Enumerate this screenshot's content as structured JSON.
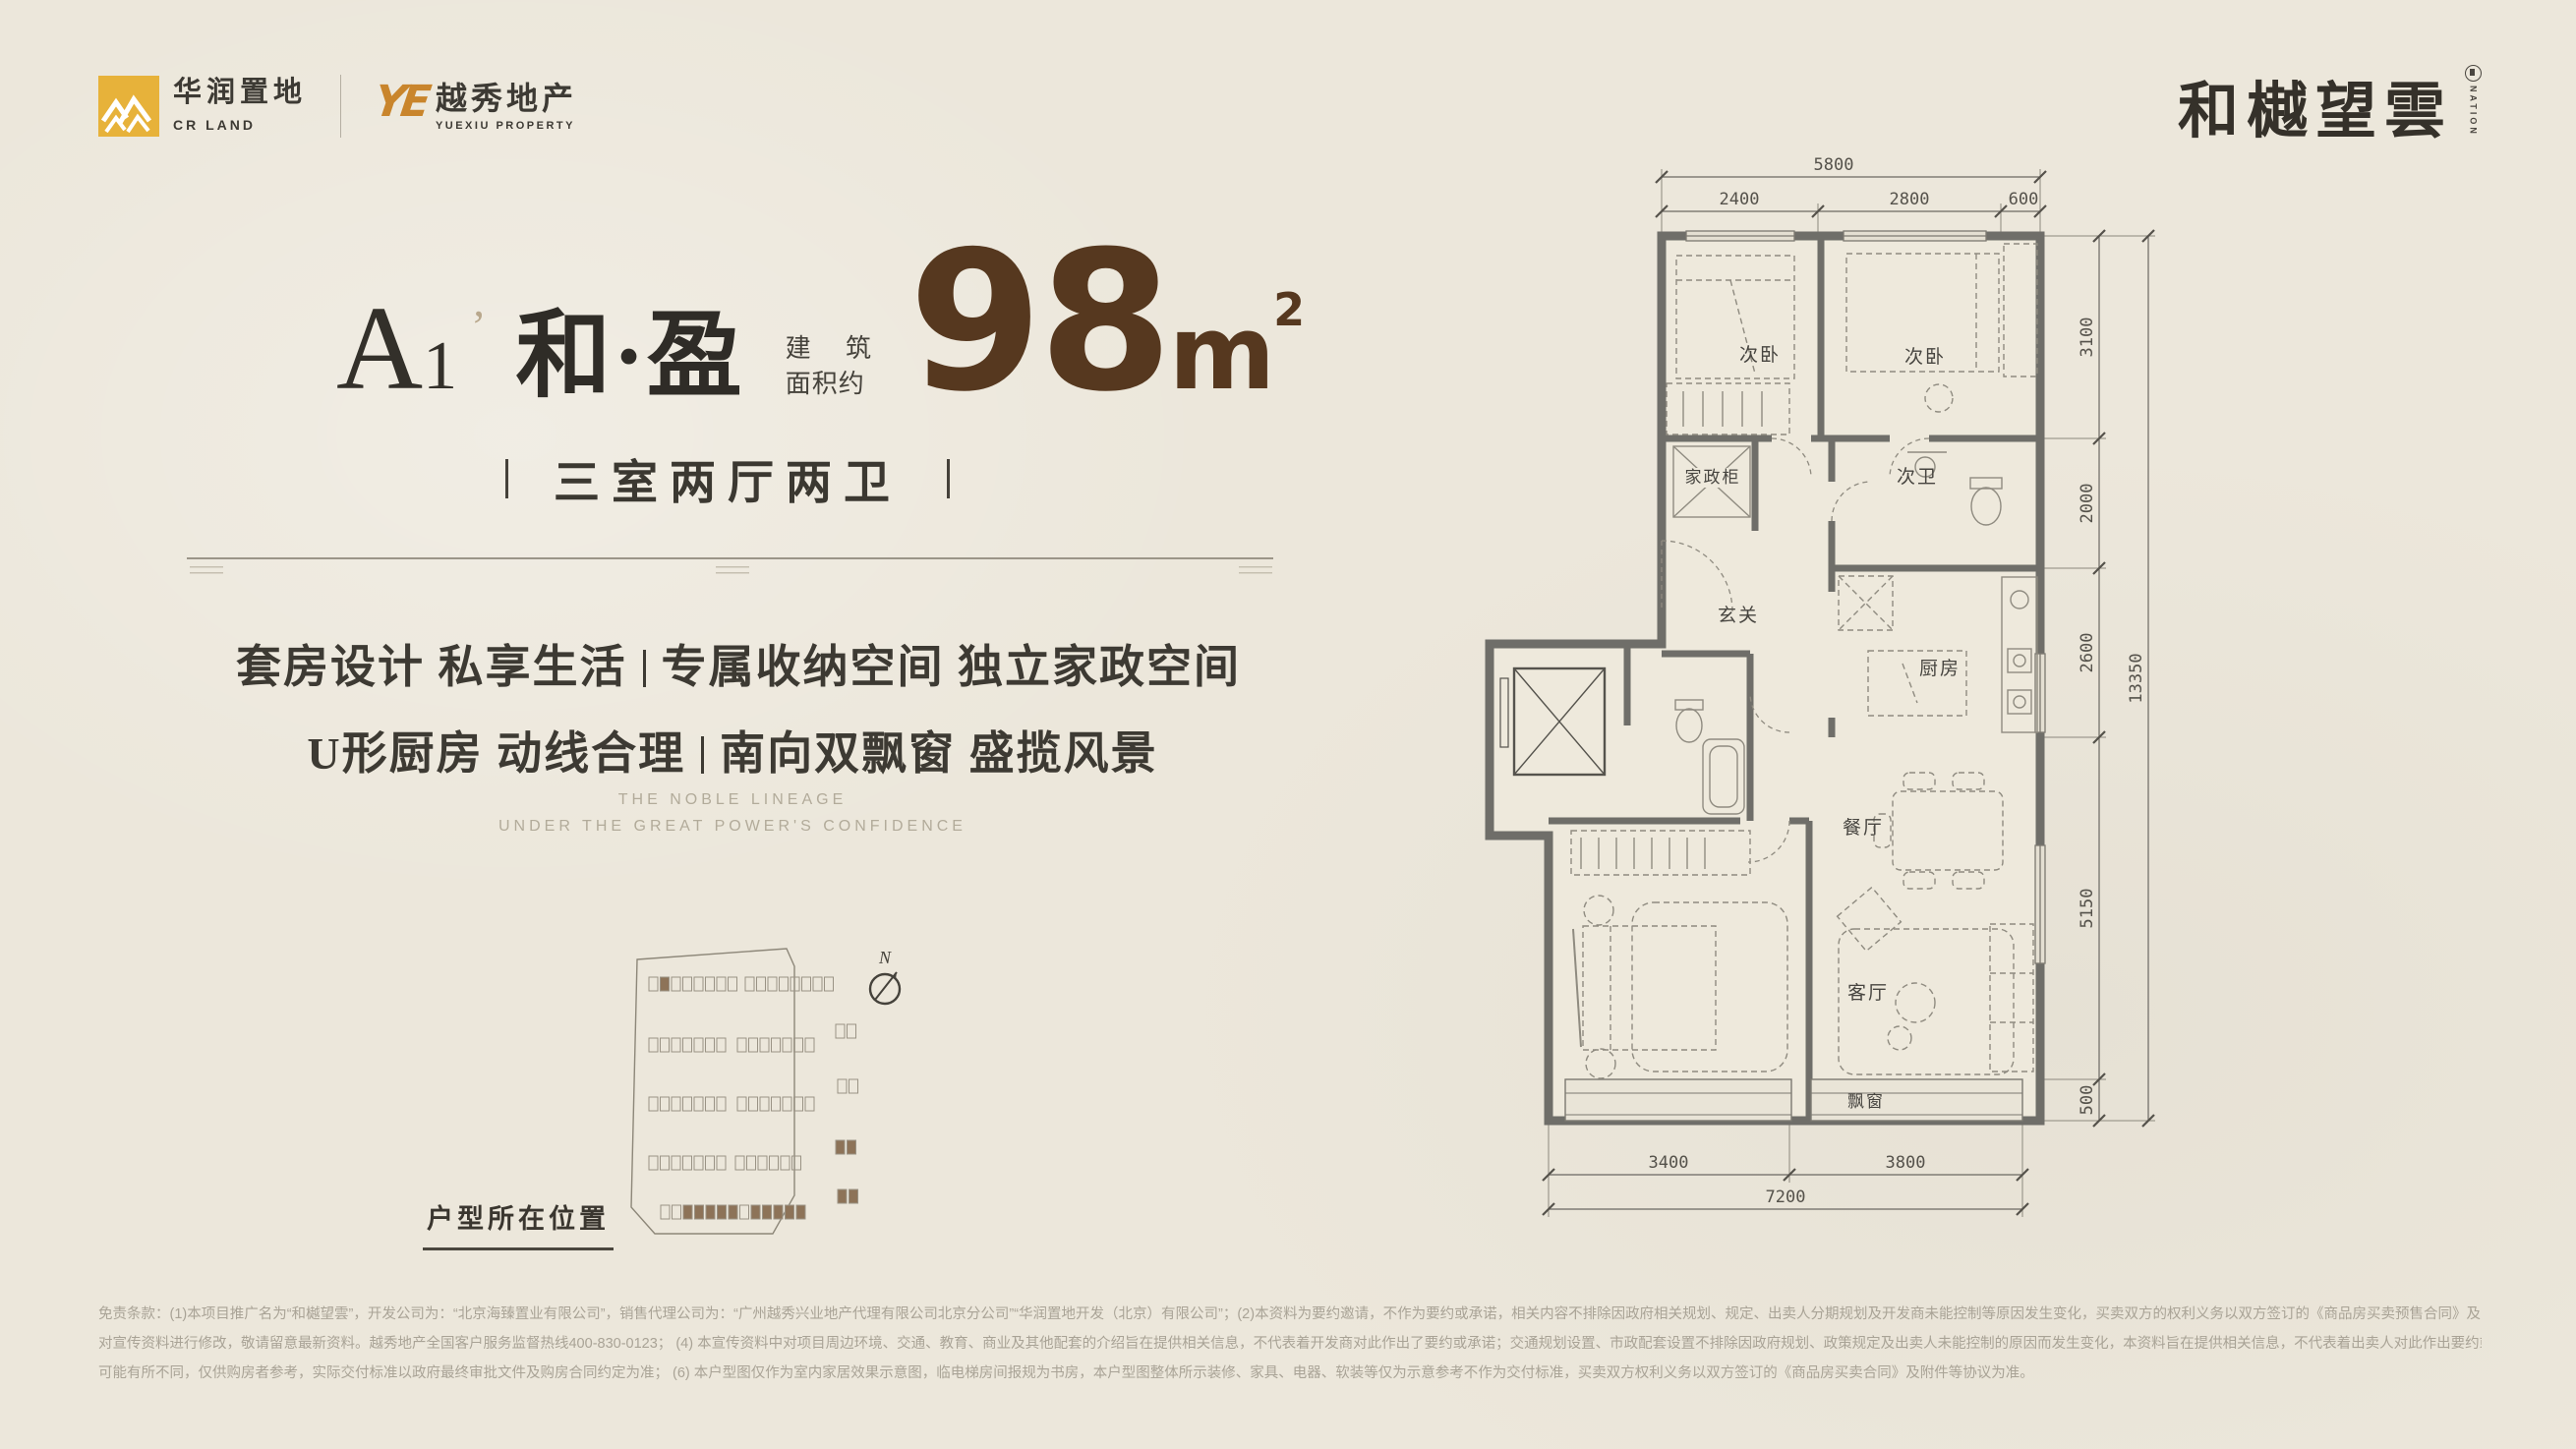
{
  "header": {
    "crland": {
      "cn": "华润置地",
      "en": "CR LAND"
    },
    "yuexiu": {
      "mark": "YE",
      "cn": "越秀地产",
      "en": "YUEXIU PROPERTY"
    },
    "brand": {
      "name": "和樾望雲",
      "seal": "NATION"
    }
  },
  "unit": {
    "model_letter": "A",
    "model_digit": "1",
    "model_mark": "’",
    "series": "和·盈",
    "area_label1": "建 筑",
    "area_label2": "面积约",
    "area_value": "98",
    "area_unit_base": "m",
    "area_unit_sup": "2",
    "layout": "三室两厅两卫"
  },
  "selling_points": [
    "套房设计 私享生活",
    "专属收纳空间 独立家政空间",
    "U形厨房 动线合理",
    "南向双飘窗 盛揽风景"
  ],
  "tagline": [
    "THE NOBLE LINEAGE",
    "UNDER THE GREAT POWER'S CONFIDENCE"
  ],
  "site_map": {
    "caption": "户型所在位置",
    "compass": "N"
  },
  "floor_plan": {
    "rooms": {
      "bedroom_a": "次卧",
      "bedroom_b": "次卧",
      "bath_second": "次卫",
      "housekeeping": "家政柜",
      "foyer": "玄关",
      "kitchen": "厨房",
      "dining": "餐厅",
      "living": "客厅",
      "bay_window": "飘窗"
    },
    "dims": {
      "top": {
        "overall": "5800",
        "seg1": "2400",
        "seg2": "2800",
        "seg3": "600"
      },
      "right": {
        "overall": "13350",
        "seg1": "3100",
        "seg2": "2000",
        "seg3": "2600",
        "seg4": "5150",
        "seg5": "500"
      },
      "bottom": {
        "overall": "7200",
        "seg1": "3400",
        "seg2": "3800"
      }
    }
  },
  "disclaimer": [
    "免责条款：(1)本项目推广名为“和樾望雲”，开发公司为：“北京海臻置业有限公司”，销售代理公司为：“广州越秀兴业地产代理有限公司北京分公司”“华润置地开发（北京）有限公司”；(2)本资料为要约邀请，不作为要约或承诺，相关内容不排除因政府相关规划、规定、出卖人分期规划及开发商未能控制等原因发生变化，买卖双方的权利义务以双方签订的《商品房买卖预售合同》及附件等协议为准； (3) 本宣传资料所采用图片除特别注明外，均为效果图、示意图，仅供参考。本宣传资料所发布的内容为【2025】年【02】月【28】日前的信息，出卖人可能会不定期",
    "对宣传资料进行修改，敬请留意最新资料。越秀地产全国客户服务监督热线400-830-0123； (4) 本宣传资料中对项目周边环境、交通、教育、商业及其他配套的介绍旨在提供相关信息，不代表着开发商对此作出了要约或承诺；交通规划设置、市政配套设置不排除因政府规划、政策规定及出卖人未能控制的原因而发生变化，本资料旨在提供相关信息，不代表着出卖人对此作出要约或承诺。 (5) 本户型图建筑面积约为98㎡，所标尺寸仅供参考，相同户型因建筑立面、楼栋、单元、楼层等差异，局部结构、层高、面积、管线布局、设备平台、空调机位、门窗洞口等",
    "可能有所不同，仅供购房者参考，实际交付标准以政府最终审批文件及购房合同约定为准； (6) 本户型图仅作为室内家居效果示意图，临电梯房间报规为书房，本户型图整体所示装修、家具、电器、软装等仅为示意参考不作为交付标准，买卖双方权利义务以双方签订的《商品房买卖合同》及附件等协议为准。"
  ],
  "colors": {
    "background": "#ece7db",
    "accent_brown": "#56381f",
    "wall_gray": "#6f6e69",
    "cr_yellow": "#e7b23a",
    "yx_orange": "#c9852c",
    "site_brown": "#8d7358"
  }
}
